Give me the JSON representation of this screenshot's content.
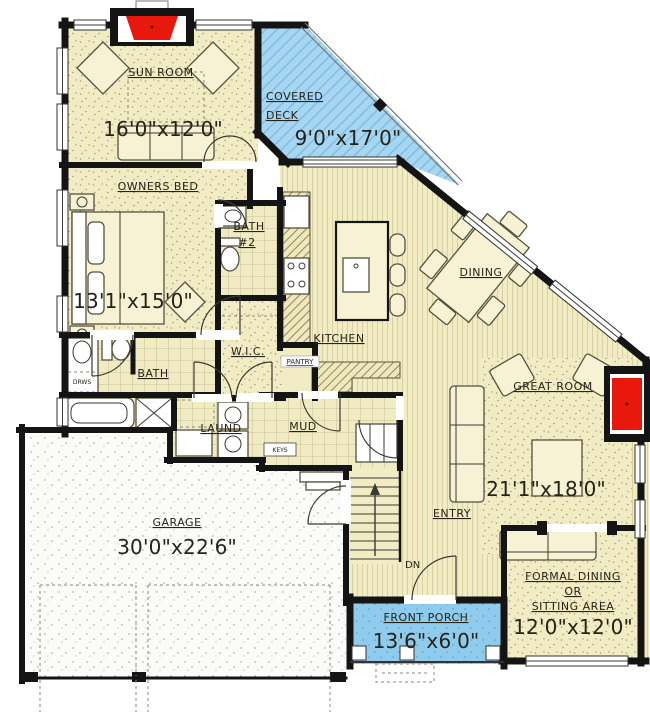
{
  "plan_title": "First floor plan",
  "colors": {
    "wall": "#141414",
    "floor_cream": "#f2ecc4",
    "floor_stripe": "#d9d1a2",
    "carpet_dot": "#a79e74",
    "deck_blue": "#a6d6f2",
    "porch_blue": "#8fcbec",
    "fireplace_red": "#e8190c",
    "garage_floor": "#fbfbf9"
  },
  "rooms": {
    "sun_room": {
      "name": "SUN ROOM",
      "dim": "16'0\"x12'0\""
    },
    "covered_deck": {
      "name_line1": "COVERED",
      "name_line2": "DECK",
      "dim": "9'0\"x17'0\""
    },
    "owners_bed": {
      "name": "OWNERS BED",
      "dim": "13'1\"x15'0\""
    },
    "bath_2": {
      "name_line1": "BATH",
      "name_line2": "#2"
    },
    "dining": {
      "name": "DINING"
    },
    "kitchen": {
      "name": "KITCHEN"
    },
    "pantry": {
      "name": "PANTRY"
    },
    "wic": {
      "name": "W.I.C."
    },
    "bath": {
      "name": "BATH",
      "drawers_label": "DRWS"
    },
    "laundry": {
      "name": "LAUND"
    },
    "mud": {
      "name": "MUD",
      "keys_label": "KEYS"
    },
    "great_room": {
      "name": "GREAT ROOM",
      "dim": "21'1\"x18'0\""
    },
    "garage": {
      "name": "GARAGE",
      "dim": "30'0\"x22'6\""
    },
    "entry": {
      "name": "ENTRY"
    },
    "stairs": {
      "direction_label": "DN"
    },
    "front_porch": {
      "name": "FRONT PORCH",
      "dim": "13'6\"x6'0\""
    },
    "formal_dining": {
      "name_line1": "FORMAL DINING",
      "name_line2": "OR",
      "name_line3": "SITTING AREA",
      "dim": "12'0\"x12'0\""
    }
  }
}
